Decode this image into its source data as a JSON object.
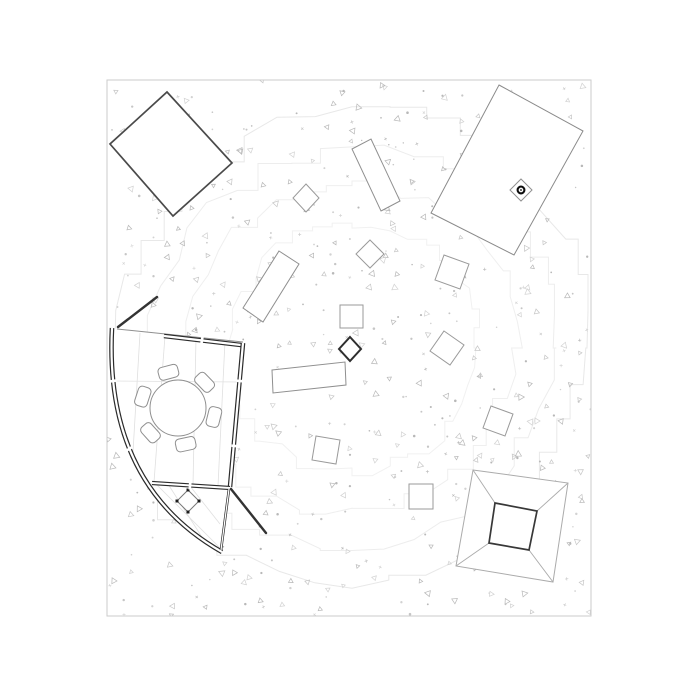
{
  "canvas": {
    "w": 700,
    "h": 700,
    "bg": "#ffffff"
  },
  "frame": {
    "x": 107,
    "y": 80,
    "w": 484,
    "h": 536,
    "stroke": "#cbcbcb",
    "stroke_width": 1
  },
  "texture": {
    "seed": 9,
    "count": 560,
    "colors": [
      "#c6c6c6",
      "#b8b8b8",
      "#d2d2d2"
    ],
    "triangle_ratio": 0.5,
    "dot_ratio": 0.35
  },
  "contours": {
    "seed": 21,
    "cx": 352,
    "cy": 348,
    "rings": [
      {
        "r": 125,
        "stroke": "#f1f1f1"
      },
      {
        "r": 165,
        "stroke": "#efefef"
      },
      {
        "r": 200,
        "stroke": "#ededed"
      },
      {
        "r": 236,
        "stroke": "#e8e8e8"
      }
    ]
  },
  "buildings": {
    "rotated_square_nw": {
      "points": [
        [
          167,
          92
        ],
        [
          232,
          163
        ],
        [
          173,
          216
        ],
        [
          110,
          144
        ]
      ],
      "stroke": "#4a4a4a",
      "width": 1.7
    },
    "rect_ne": {
      "points": [
        [
          499,
          85
        ],
        [
          583,
          131
        ],
        [
          514,
          255
        ],
        [
          431,
          213
        ]
      ],
      "stroke": "#8a8a8a",
      "width": 1
    },
    "column_marker": {
      "diamond": [
        [
          521,
          179
        ],
        [
          532,
          190
        ],
        [
          521,
          201
        ],
        [
          510,
          190
        ]
      ],
      "diamond_stroke": "#909090",
      "dot_cx": 521,
      "dot_cy": 190,
      "ring_r": 3.4,
      "ring_stroke": "#0d0d0d",
      "ring_width": 2.1,
      "dot_r": 0.9,
      "dot_fill": "#0d0d0d"
    }
  },
  "blocks": [
    {
      "name": "rect-tall-north",
      "points": [
        [
          371,
          139
        ],
        [
          400,
          201
        ],
        [
          381,
          211
        ],
        [
          352,
          149
        ]
      ],
      "stroke": "#8f8f8f",
      "width": 1
    },
    {
      "name": "diamond-north-west",
      "points": [
        [
          306,
          184
        ],
        [
          319,
          198
        ],
        [
          306,
          212
        ],
        [
          293,
          198
        ]
      ],
      "stroke": "#9a9a9a",
      "width": 1
    },
    {
      "name": "rect-tall-west",
      "points": [
        [
          279,
          251
        ],
        [
          299,
          264
        ],
        [
          263,
          322
        ],
        [
          243,
          308
        ]
      ],
      "stroke": "#8f8f8f",
      "width": 1
    },
    {
      "name": "rect-wide-center",
      "points": [
        [
          272,
          370
        ],
        [
          345,
          362
        ],
        [
          346,
          385
        ],
        [
          273,
          393
        ]
      ],
      "stroke": "#8f8f8f",
      "width": 1
    },
    {
      "name": "diamond-dark-center",
      "points": [
        [
          350,
          337
        ],
        [
          361,
          349
        ],
        [
          350,
          361
        ],
        [
          339,
          349
        ]
      ],
      "stroke": "#2e2e2e",
      "width": 2
    },
    {
      "name": "square-center-north",
      "points": [
        [
          340,
          305
        ],
        [
          363,
          305
        ],
        [
          363,
          328
        ],
        [
          340,
          328
        ]
      ],
      "stroke": "#9a9a9a",
      "width": 1
    },
    {
      "name": "diamond-center",
      "points": [
        [
          370,
          240
        ],
        [
          384,
          254
        ],
        [
          370,
          268
        ],
        [
          356,
          254
        ]
      ],
      "stroke": "#9a9a9a",
      "width": 1
    },
    {
      "name": "square-tilted-east",
      "points": [
        [
          444,
          255
        ],
        [
          469,
          264
        ],
        [
          460,
          289
        ],
        [
          435,
          280
        ]
      ],
      "stroke": "#9a9a9a",
      "width": 1
    },
    {
      "name": "square-tilted-center-east",
      "points": [
        [
          444,
          331
        ],
        [
          464,
          345
        ],
        [
          450,
          365
        ],
        [
          430,
          351
        ]
      ],
      "stroke": "#9a9a9a",
      "width": 1
    },
    {
      "name": "square-tilted-far-east",
      "points": [
        [
          491,
          406
        ],
        [
          513,
          414
        ],
        [
          505,
          436
        ],
        [
          483,
          428
        ]
      ],
      "stroke": "#9a9a9a",
      "width": 1
    },
    {
      "name": "square-tilted-south-center",
      "points": [
        [
          316,
          436
        ],
        [
          340,
          440
        ],
        [
          336,
          464
        ],
        [
          312,
          460
        ]
      ],
      "stroke": "#9a9a9a",
      "width": 1
    },
    {
      "name": "square-south-center",
      "points": [
        [
          409,
          484
        ],
        [
          433,
          484
        ],
        [
          433,
          509
        ],
        [
          409,
          509
        ]
      ],
      "stroke": "#9a9a9a",
      "width": 1
    }
  ],
  "pyramid": {
    "outer": [
      [
        473,
        470
      ],
      [
        568,
        483
      ],
      [
        553,
        582
      ],
      [
        456,
        566
      ]
    ],
    "inner": [
      [
        495,
        503
      ],
      [
        537,
        511
      ],
      [
        529,
        550
      ],
      [
        489,
        543
      ]
    ],
    "outer_stroke": "#ababab",
    "outer_width": 1,
    "inner_stroke": "#383838",
    "inner_width": 1.7,
    "diag_stroke": "#ababab",
    "diag_width": 0.9
  },
  "room": {
    "outline_path": "M112,328 L243,343 L230,487 L222,552 Q104,485 112,328 Z",
    "floor_color": "#e0e0e0",
    "floor_lines": [
      [
        165,
        336,
        154,
        482
      ],
      [
        196,
        338,
        193,
        485
      ],
      [
        225,
        341,
        218,
        486
      ],
      [
        140,
        333,
        133,
        452
      ],
      [
        114,
        381,
        240,
        382
      ],
      [
        168,
        484,
        207,
        545
      ],
      [
        190,
        486,
        220,
        524
      ],
      [
        155,
        483,
        221,
        549
      ]
    ],
    "thin_lines": [
      {
        "x1": 117,
        "y1": 329,
        "x2": 243,
        "y2": 342,
        "w": 1,
        "color": "#8f8f8f"
      }
    ],
    "wall_color": "#2b2b2b",
    "walls": [
      {
        "d": "M164,336 L241,345",
        "outer": 4.6,
        "inner": 2.2
      },
      {
        "d": "M243,343 L230,487",
        "outer": 4.6,
        "inner": 2.2
      },
      {
        "d": "M112,328 Q104,485 222,552",
        "outer": 4.6,
        "inner": 2.2
      },
      {
        "d": "M152,483 L230,488",
        "outer": 4.2,
        "inner": 2.0
      },
      {
        "d": "M229,489 L221,550",
        "outer": 2.6,
        "inner": 1.2
      }
    ],
    "gaps": [
      {
        "x": 202,
        "y": 340,
        "a": 7
      },
      {
        "x": 240,
        "y": 381,
        "a": 96
      },
      {
        "x": 235,
        "y": 446,
        "a": 96
      },
      {
        "x": 113,
        "y": 381,
        "a": 82
      },
      {
        "x": 129,
        "y": 449,
        "a": 60
      },
      {
        "x": 190,
        "y": 486,
        "a": 4
      }
    ],
    "dark_lines": [
      {
        "x1": 118,
        "y1": 327,
        "x2": 157,
        "y2": 297,
        "w": 2.4
      },
      {
        "x1": 231,
        "y1": 489,
        "x2": 266,
        "y2": 533,
        "w": 2.4
      }
    ],
    "dark_line_color": "#333333",
    "table": {
      "cx": 178,
      "cy": 408,
      "r": 28,
      "stroke": "#8f8f8f",
      "width": 1
    },
    "chairs": {
      "orbit": 37,
      "w": 20,
      "h": 13,
      "rx": 4,
      "angles": [
        -105,
        -44,
        14,
        78,
        138,
        198
      ],
      "stroke": "#8f8f8f",
      "width": 1
    },
    "cabinet": {
      "pts": [
        [
          188,
          490
        ],
        [
          199,
          501
        ],
        [
          188,
          512
        ],
        [
          177,
          501
        ]
      ],
      "stroke": "#787878",
      "width": 1,
      "dot_fill": "#1c1c1c",
      "dot_size": 3
    }
  }
}
